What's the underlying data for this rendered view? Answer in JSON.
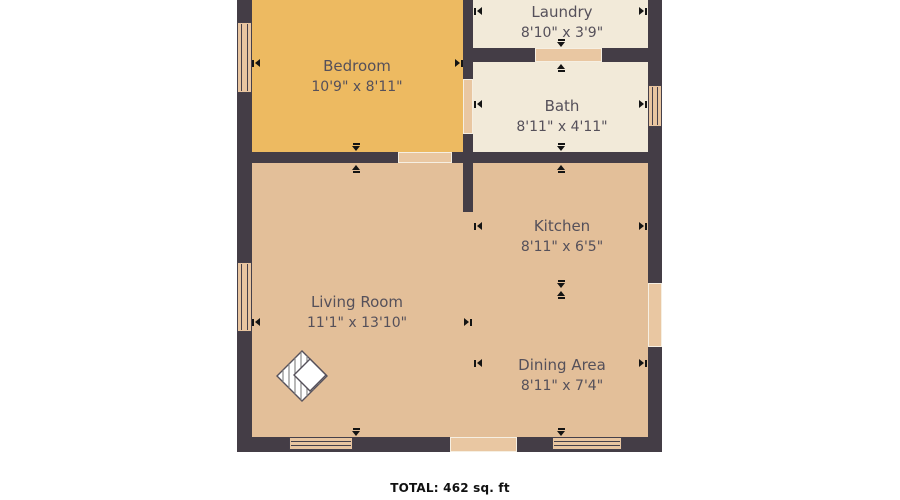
{
  "plan": {
    "rooms": [
      {
        "id": "bedroom",
        "name": "Bedroom",
        "dims": "10'9\" x 8'11\""
      },
      {
        "id": "laundry",
        "name": "Laundry",
        "dims": "8'10\" x 3'9\""
      },
      {
        "id": "bath",
        "name": "Bath",
        "dims": "8'11\" x 4'11\""
      },
      {
        "id": "kitchen",
        "name": "Kitchen",
        "dims": "8'11\" x 6'5\""
      },
      {
        "id": "living",
        "name": "Living Room",
        "dims": "11'1\" x 13'10\""
      },
      {
        "id": "dining",
        "name": "Dining Area",
        "dims": "8'11\" x 7'4\""
      }
    ],
    "total_label": "TOTAL: 462 sq. ft",
    "icons": {
      "floor_marker": "diamond-hatch-icon"
    },
    "colors": {
      "background": "#FFFFFF",
      "wall": "#443D46",
      "bedroom_fill": "#EDBA61",
      "laundry_fill": "#F2EAD9",
      "main_fill": "#E3BF99",
      "opening_fill": "#E9C7A2",
      "opening_edge": "#F6EFE2",
      "window_fill": "#E8C5A0",
      "window_line": "#46404A",
      "arrow": "#141414",
      "label_text": "#55505A",
      "total_text": "#111111"
    }
  }
}
